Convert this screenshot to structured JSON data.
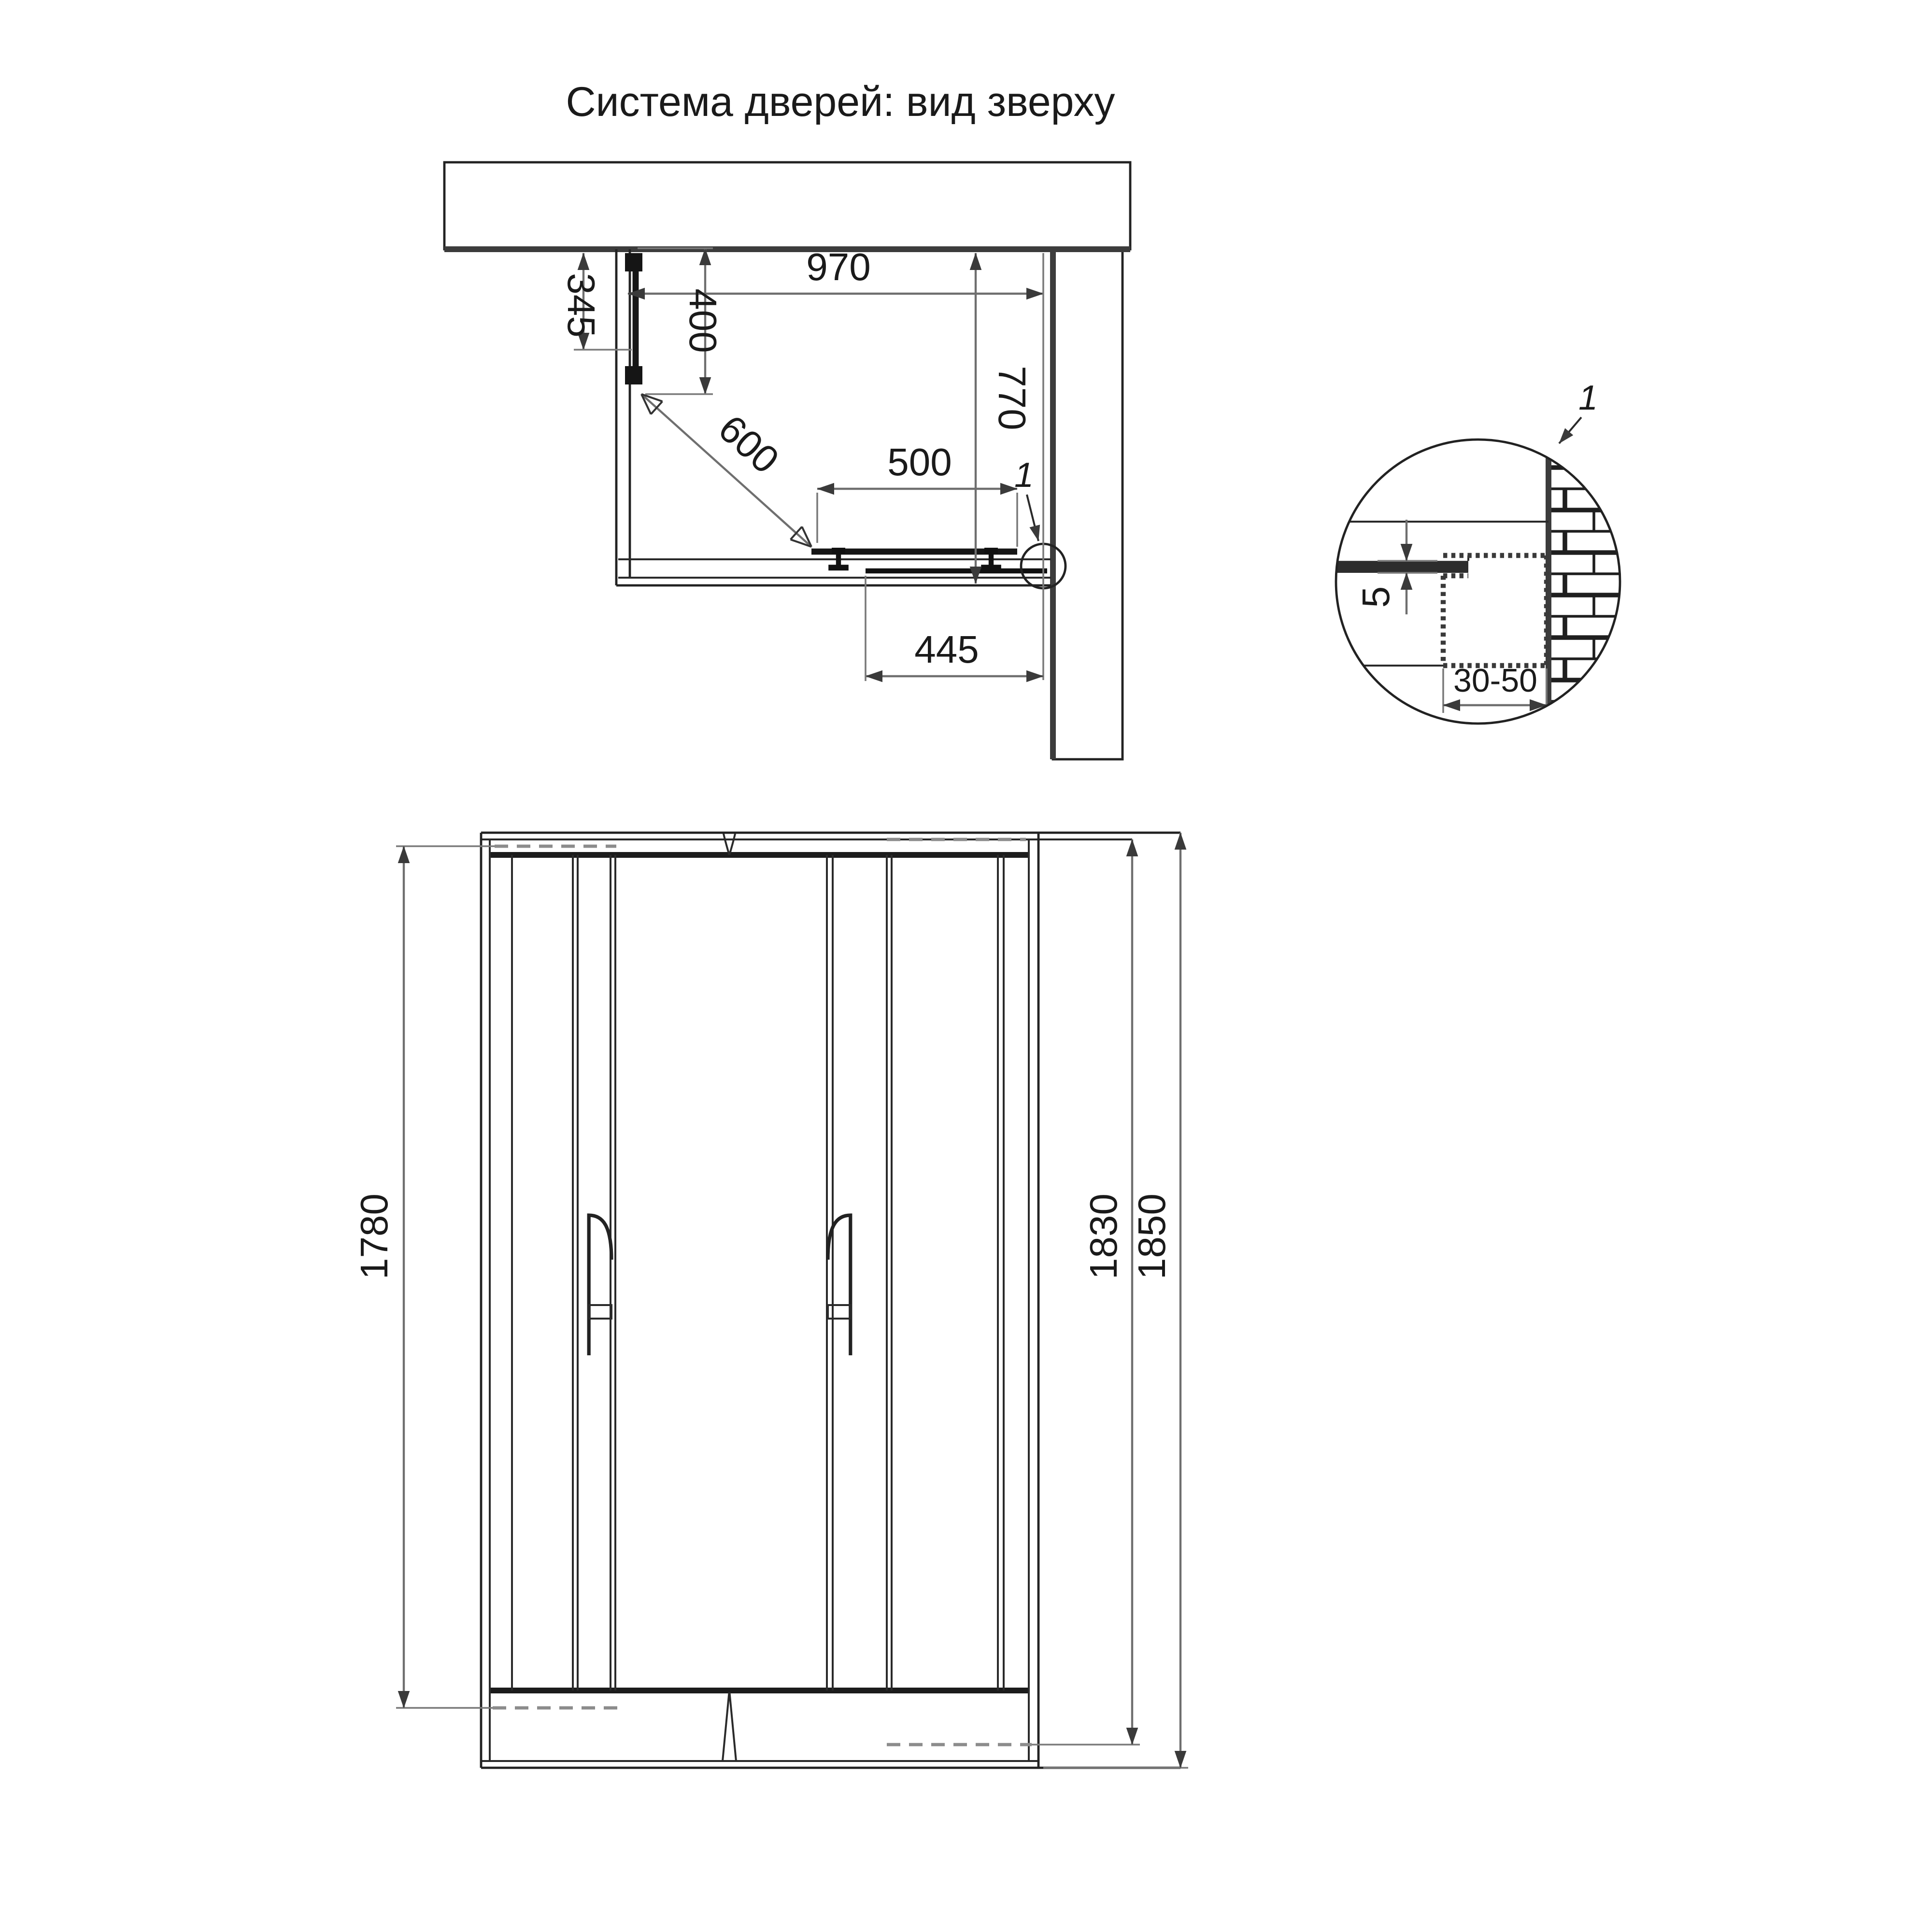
{
  "title": "Система дверей: вид зверху",
  "top_view": {
    "dim_width": "970",
    "dim_wall_offset": "345",
    "dim_panel": "400",
    "dim_diagonal": "600",
    "dim_door": "500",
    "dim_depth": "770",
    "dim_travel": "445",
    "detail_ref": "1"
  },
  "detail_view": {
    "dim_glass_gap": "5",
    "dim_profile_width": "30-50",
    "detail_ref": "1"
  },
  "front_view": {
    "dim_door_height": "1780",
    "dim_inner_height": "1830",
    "dim_total_height": "1850"
  }
}
